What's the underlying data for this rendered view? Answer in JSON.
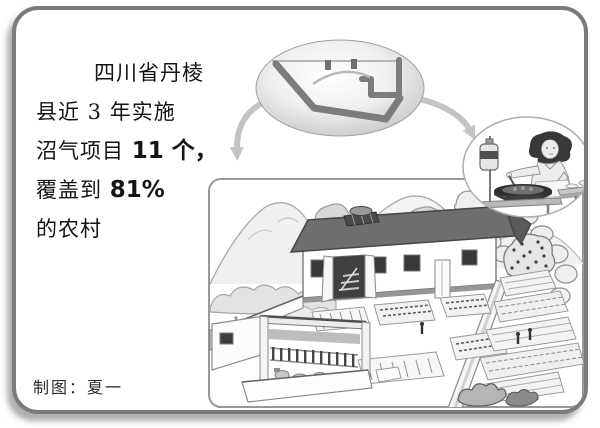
{
  "frame": {
    "background": "#ffffff",
    "border_color": "#7b7b7b"
  },
  "intro": {
    "lines": [
      {
        "pre": "四川省丹棱",
        "bold": ""
      },
      {
        "pre": "县近 3 年实施",
        "bold": ""
      },
      {
        "pre": "沼气项目 ",
        "bold": "11 个，"
      },
      {
        "pre": "覆盖到 ",
        "bold": "81%"
      },
      {
        "pre": "的农村",
        "bold": ""
      }
    ]
  },
  "biogas_pit": {
    "label": "沼气池"
  },
  "credit": {
    "label": "制图：夏一"
  },
  "palette": {
    "ink": "#111111",
    "line_gray": "#8a8a8a",
    "light_gray": "#c4c4c4",
    "roof_gray": "#6e6e6e",
    "panel_border": "#999999"
  }
}
